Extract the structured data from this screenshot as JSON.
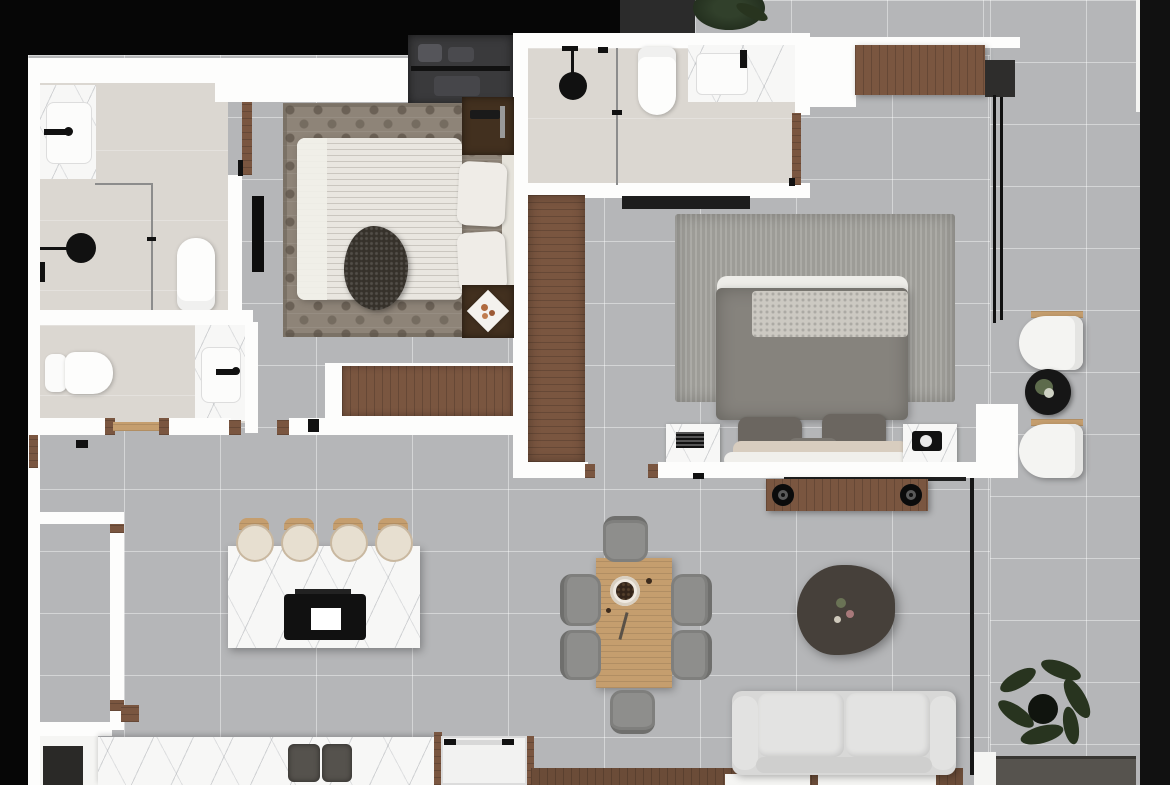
{
  "meta": {
    "type": "architectural floor plan rendering",
    "view": "top-down",
    "background": "black"
  },
  "palette": {
    "bg": "#060606",
    "wall": "#fdfdfc",
    "tile": "#b5b6b8",
    "bathFloor": "#dbd7d1",
    "marbleBase": "#f7f7f6",
    "wood": "#7a5640",
    "woodLight": "#c59e6e",
    "woodDark": "#42301f",
    "ink": "#111111",
    "plant": "#28341f",
    "sofaBase": "#d8d8d7",
    "chairGray": "#8e8e8c",
    "duvetMaster": "#86837d",
    "knit": "#ccc9c2",
    "rugSmallBase": "#8e8478",
    "rugLargeBase": "#9d9c97",
    "wardrobeDark": "#3a3a3c",
    "consoleDark": "#56534e"
  },
  "rooms": [
    {
      "name": "bathroom-1",
      "furniture": [
        "marble-vanity-sink",
        "walk-in-shower",
        "toilet",
        "glass-partition"
      ]
    },
    {
      "name": "powder-room",
      "furniture": [
        "toilet",
        "marble-vanity-sink"
      ]
    },
    {
      "name": "bedroom-1",
      "furniture": [
        "double-bed",
        "patterned-rug",
        "dark-wood-nightstand-x2",
        "wall-tv",
        "built-in-wardrobe",
        "wood-dresser",
        "fur-throw"
      ]
    },
    {
      "name": "bathroom-2",
      "furniture": [
        "walk-in-shower",
        "toilet",
        "marble-vanity-sink",
        "dark-doormat"
      ]
    },
    {
      "name": "master-bedroom",
      "furniture": [
        "double-bed",
        "ribbed-area-rug",
        "marble-nightstand-x2",
        "tall-wood-wardrobe",
        "wood-media-bench",
        "wood-console"
      ]
    },
    {
      "name": "living-dining-kitchen",
      "furniture": [
        "marble-kitchen-island",
        "cooktop",
        "bar-stool-x4",
        "double-sink-counter",
        "white-appliance",
        "wood-dining-table",
        "dining-chair-x6",
        "decor-bowl",
        "gray-sofa",
        "organic-coffee-table"
      ]
    },
    {
      "name": "balcony",
      "furniture": [
        "lounge-chair-x2",
        "round-black-side-table",
        "potted-plant-x2",
        "dark-sideboard",
        "window-wall"
      ]
    }
  ]
}
